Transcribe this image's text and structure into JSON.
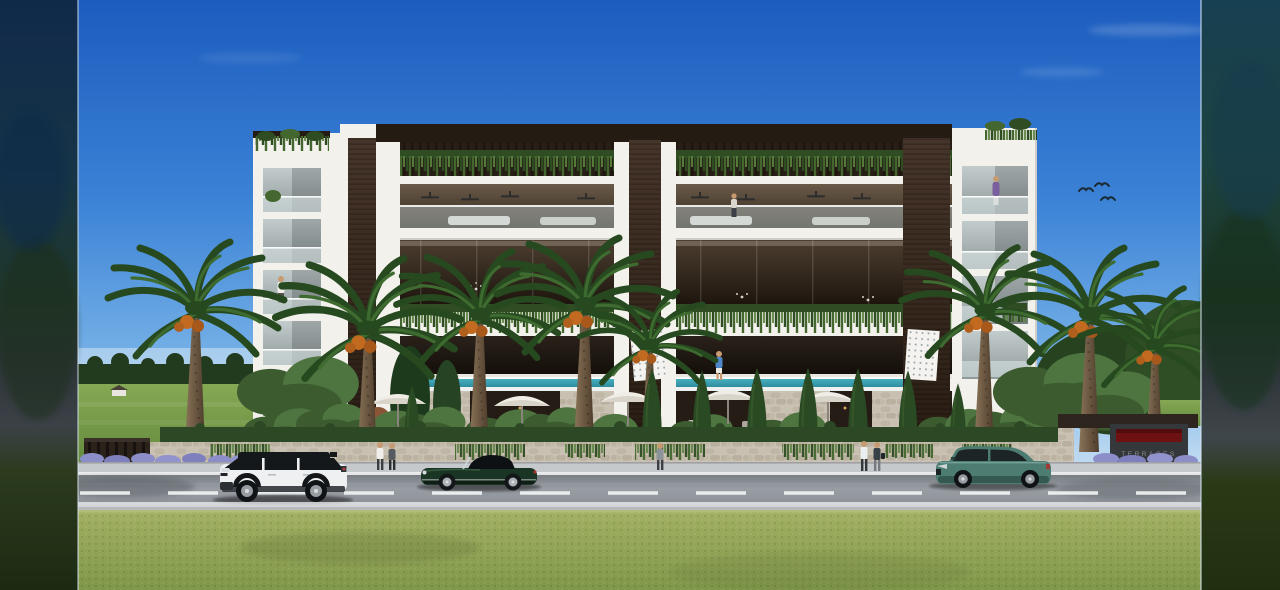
{
  "entrance": {
    "sign_label": "TERRACES"
  },
  "scene": {
    "setting": "photorealistic architectural render of a modern white-and-dark-wood apartment building behind a stone garden wall, viewed from across a road with a lawn in the foreground",
    "sky": {
      "birds": 3,
      "clouds": "faint thin wisps, upper right"
    },
    "building": {
      "floors_visible": 5,
      "towers": 2,
      "materials": [
        "white concrete",
        "dark timber",
        "glass balustrades"
      ],
      "features": [
        "hanging planters under pergola roof",
        "infinity pool ledge",
        "perforated white panels",
        "ceiling fans",
        "people on balconies"
      ]
    },
    "vehicles": [
      {
        "type": "white SUV with black roof",
        "lane": "near",
        "facing": "left"
      },
      {
        "type": "dark green classic roadster, black soft top",
        "lane": "far",
        "facing": "left"
      },
      {
        "type": "teal fastback sedan",
        "lane": "far",
        "facing": "left"
      }
    ],
    "people": {
      "sidewalk": 5,
      "balconies": 3,
      "pool_deck": 1
    },
    "vegetation": [
      "date palms with orange fruit",
      "cypress trees",
      "round shrubs",
      "hedge on stone wall",
      "lavender beds",
      "distant tree line and green field (left)"
    ],
    "road": {
      "markings": [
        "solid white edge lines",
        "dashed white center line"
      ]
    },
    "framing": "sharp image letterboxed between dark blurred vertical bands at left and right edges"
  },
  "colors": {
    "skyTop": "#1c5cbe",
    "skyMid": "#3b82d6",
    "skyLow": "#74afe6",
    "skyHorizon": "#bdd9f1",
    "buildingWhite": "#f2f1ec",
    "roofDark": "#241b13",
    "wood1": "#46352a",
    "wood2": "#281c12",
    "leaf": "#44662f",
    "leafDark": "#2f4c22",
    "leafLight": "#5d8340",
    "palmDark": "#27491f",
    "palmLight": "#3e6b2f",
    "trunk1": "#8a7458",
    "trunk2": "#4e3d2c",
    "fruit": "#c26a1f",
    "cypress": "#2a4a24",
    "bush": "#3c5c30",
    "bushLight": "#4e7440",
    "hedge": "#2c4824",
    "stone": "#cac2b4",
    "pool1": "#46b0c0",
    "pool2": "#2b8799",
    "glass1": "#c3cccd",
    "glass2": "#8f9a9b",
    "warmHi": "#6a5a48",
    "warmLo": "#32281d",
    "warm2Hi": "#4c3e30",
    "warm2Lo": "#1c140d",
    "lowHi": "#2a211a",
    "lowLo": "#120d08",
    "roadTop": "#75797f",
    "roadMid": "#999ea5",
    "roadLow": "#8c9197",
    "lane": "#f2f4f4",
    "sidewalk": "#c6c9cc",
    "curb": "#b6babd",
    "grass1": "#a3b164",
    "grass2": "#7f974a",
    "field1": "#85a854",
    "field2": "#638a3c",
    "treeline": "#223a1e",
    "suvWhite": "#eef0f2",
    "suvDark": "#15181b",
    "jagGreen": "#1b3524",
    "sedanTeal": "#4d7d72",
    "sedanDark": "#2f4f47",
    "lavender": "#8b8ec9",
    "signRed": "#6e1113",
    "skin": "#c79b72",
    "bandEdge": "#d9e6f2"
  }
}
